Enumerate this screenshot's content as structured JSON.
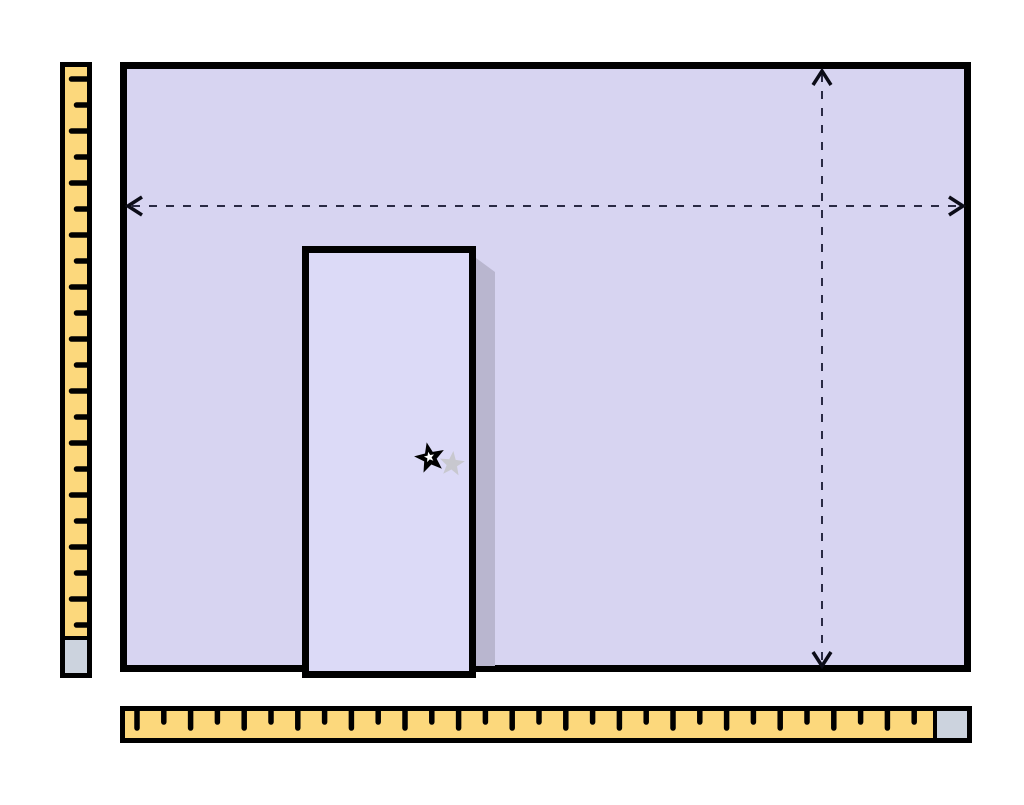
{
  "colors": {
    "page_background": "#ffffff",
    "wall_fill": "#d7d4f1",
    "door_fill": "#dcdaf7",
    "outline": "#000000",
    "door_shadow": "#b9b6cf",
    "ruler_fill": "#fcd87c",
    "ruler_end_cap": "#ccd3de",
    "dashed_line": "#2a2a44",
    "arrowhead": "#0c0c18",
    "star_fill": "#000000",
    "star_core": "#ffffff",
    "star_shadow": "#c8c8cf"
  },
  "icons": {
    "star_marker": "star-icon",
    "star_marker_shadow": "star-shadow-icon",
    "width_arrow": "double-headed-horizontal-dashed-arrow",
    "height_arrow": "double-headed-vertical-dashed-arrow"
  },
  "rulers": {
    "left": {
      "orientation": "vertical",
      "tick_count": 22,
      "tick_spacing": 26,
      "tick_long": 15,
      "tick_short": 10,
      "tick_width": 5.5,
      "start_offset": 12
    },
    "bottom": {
      "orientation": "horizontal",
      "tick_count": 30,
      "tick_spacing": 26.8,
      "tick_long": 17,
      "tick_short": 11,
      "tick_width": 5.5,
      "start_offset": 12
    }
  }
}
